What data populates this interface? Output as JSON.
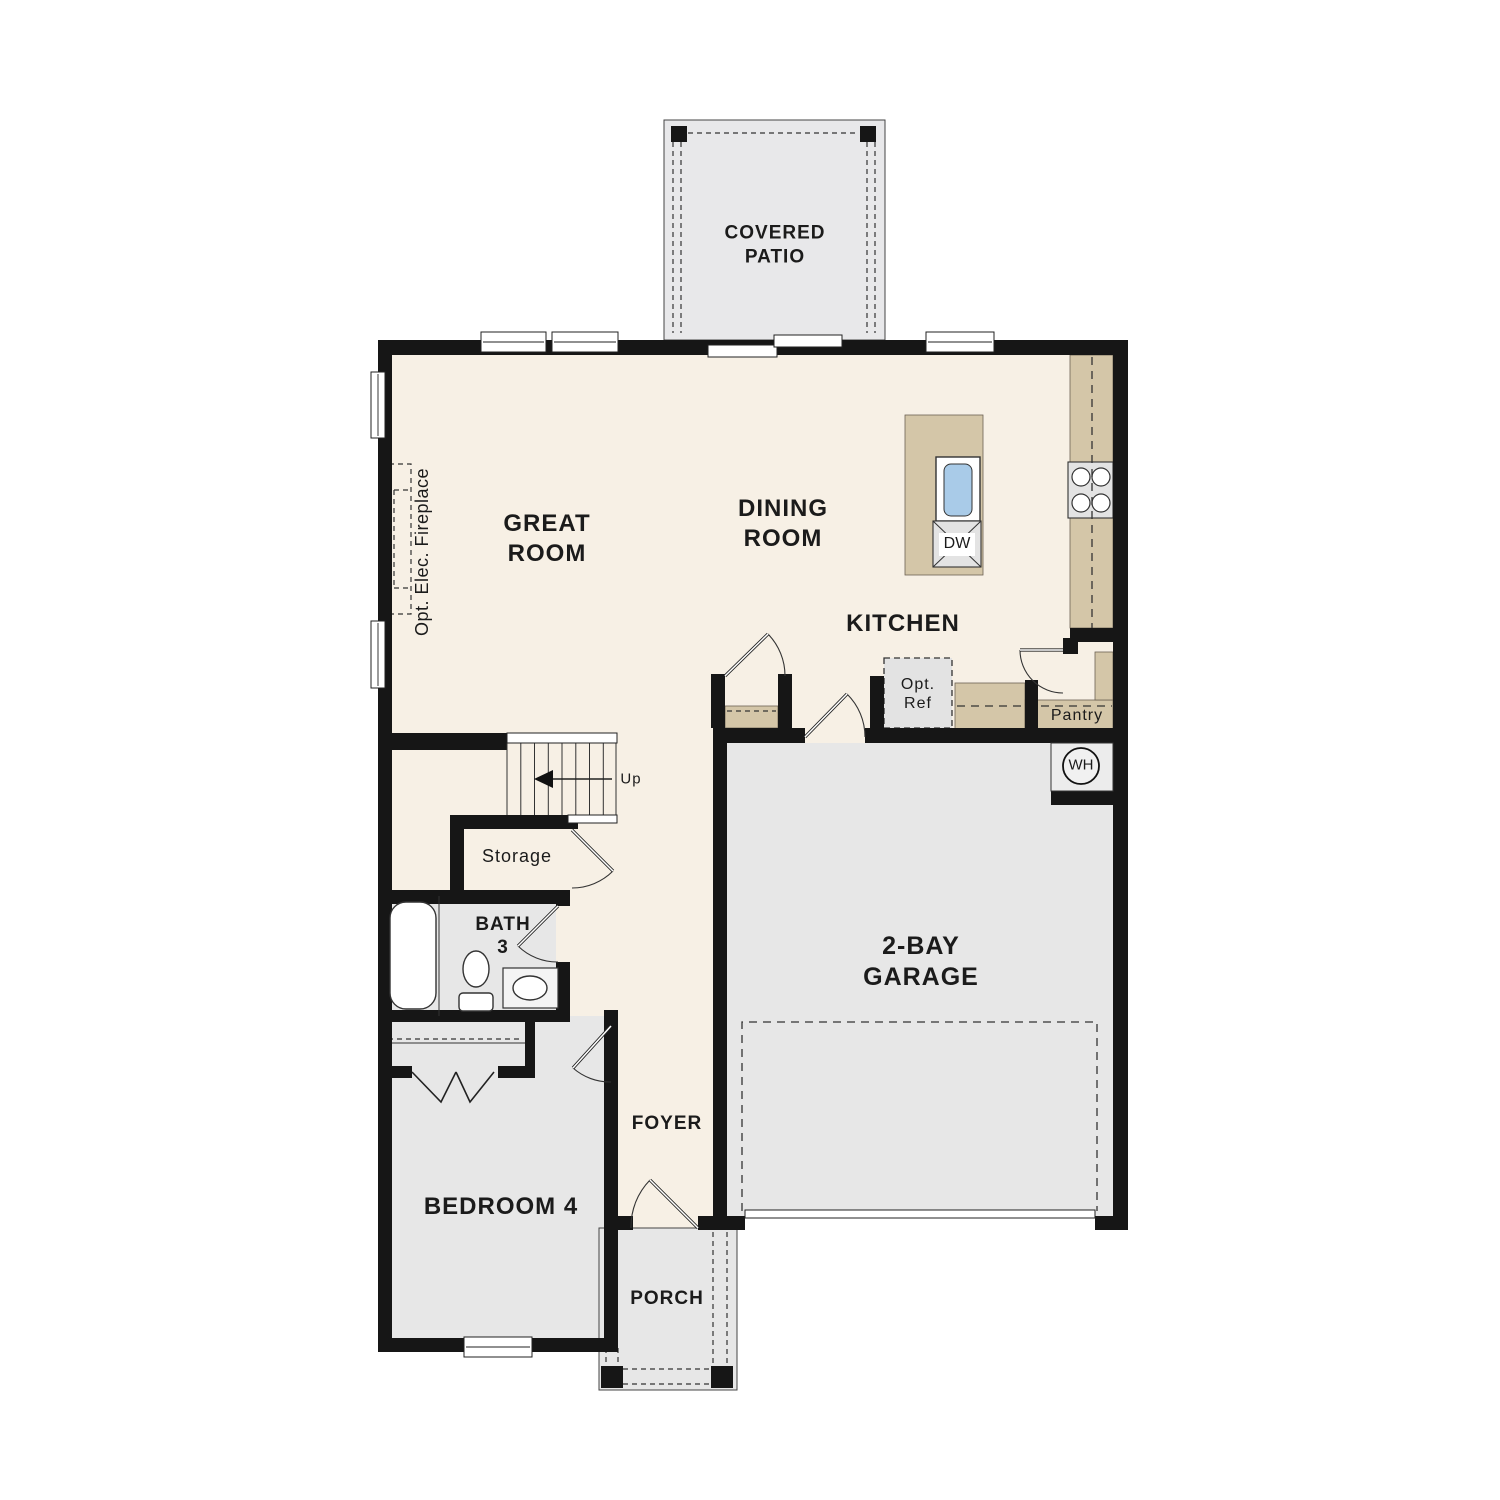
{
  "plan_title": "First Floor Plan",
  "colors": {
    "wall": "#161616",
    "cream": "#f7f0e5",
    "room_gray": "#e7e7e7",
    "patio_gray": "#e8e8ea",
    "tan": "#d4c6a8",
    "blue": "#a9cbe8",
    "appliance": "#e3e3e3"
  },
  "labels": {
    "covered_patio": "COVERED\nPATIO",
    "great_room": "GREAT\nROOM",
    "dining_room": "DINING\nROOM",
    "kitchen": "KITCHEN",
    "pantry": "Pantry",
    "opt_ref": "Opt.\nRef",
    "dishwasher": "DW",
    "water_heater": "WH",
    "stairs_up": "Up",
    "storage": "Storage",
    "bath3": "BATH\n3",
    "bedroom4": "BEDROOM 4",
    "foyer": "FOYER",
    "porch": "PORCH",
    "garage": "2-BAY\nGARAGE",
    "opt_fireplace": "Opt. Elec. Fireplace"
  }
}
